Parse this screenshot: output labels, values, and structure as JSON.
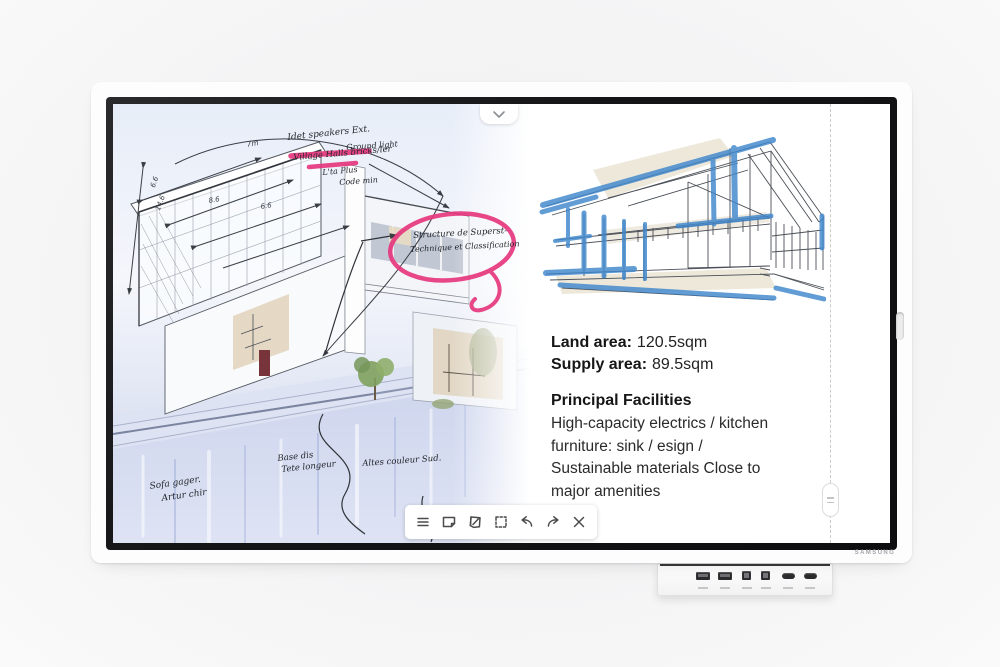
{
  "brand": {
    "logo_text": "SAMSUNG"
  },
  "colors": {
    "marker_pink": "#e6387e",
    "marker_blue": "#3f87cd",
    "ink": "#23262b"
  },
  "screen": {
    "top_handle": {
      "icon": "chevron-down"
    },
    "toolbar": {
      "icons": [
        "menu",
        "note",
        "note-import",
        "select",
        "undo",
        "redo",
        "close"
      ]
    },
    "divider": {
      "handle_icon": "grip-lines"
    },
    "left_page": {
      "dimension_labels": [
        "7m",
        "6.6",
        "8.6",
        "6.6",
        "14.6"
      ],
      "annotations": {
        "top": [
          "Idet speakers Ext.",
          "Ground light",
          "Village Halls bricks/ler",
          "L'ta Plus",
          "Code min"
        ],
        "circled": [
          "Structure de Superst-",
          "Technique et Classification"
        ],
        "bottom_left": [
          "Sofa gager.",
          "Artur chir"
        ],
        "bottom_center": [
          "Base dis",
          "Tete longeur"
        ],
        "bottom_right": [
          "Altes couleur Sud."
        ]
      }
    },
    "right_page": {
      "land_area_label": "Land area:",
      "land_area_value": "120.5sqm",
      "supply_area_label": "Supply area:",
      "supply_area_value": "89.5sqm",
      "facilities_title": "Principal Facilities",
      "facilities_lines": [
        "High-capacity electrics / kitchen",
        "furniture: sink / esign /",
        "Sustainable materials Close to",
        "major amenities"
      ]
    }
  },
  "tray": {
    "ports": [
      "usb-a",
      "usb-a",
      "usb-b",
      "usb-b",
      "hdmi",
      "hdmi"
    ]
  }
}
